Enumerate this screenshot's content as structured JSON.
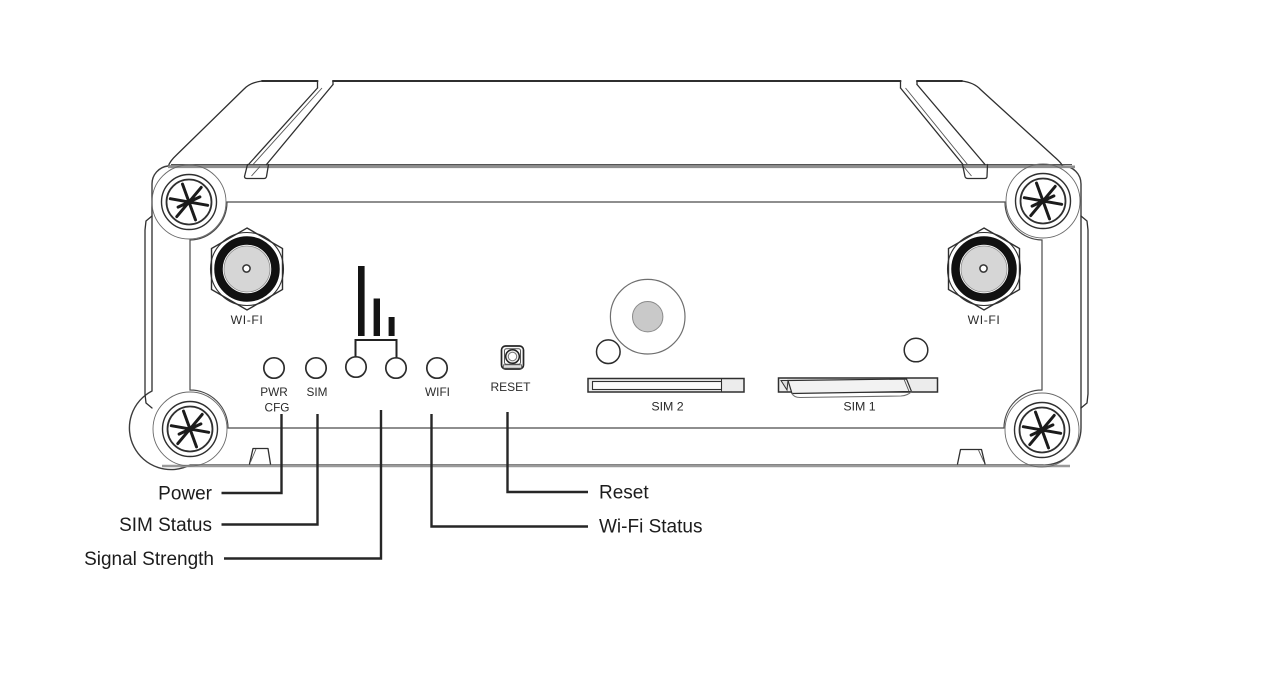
{
  "panel": {
    "antenna_left": {
      "label": "WI-FI"
    },
    "antenna_right": {
      "label": "WI-FI"
    },
    "leds": {
      "pwr": "PWR",
      "cfg": "CFG",
      "sim": "SIM",
      "wifi": "WIFI"
    },
    "reset_button": {
      "label": "RESET"
    },
    "sim_slots": {
      "sim2": "SIM 2",
      "sim1": "SIM 1"
    }
  },
  "callouts": {
    "power": "Power",
    "sim_status": "SIM Status",
    "signal_strength": "Signal Strength",
    "reset": "Reset",
    "wifi_status": "Wi-Fi Status"
  },
  "colors": {
    "line": "#2f2f2f",
    "soft_line": "#8f8f8f",
    "bar_fill": "#141414",
    "metal_fill": "#d6d6d6",
    "buzzer_fill": "#c9c9c9",
    "background": "#ffffff",
    "label_text": "#1c1c1c"
  }
}
